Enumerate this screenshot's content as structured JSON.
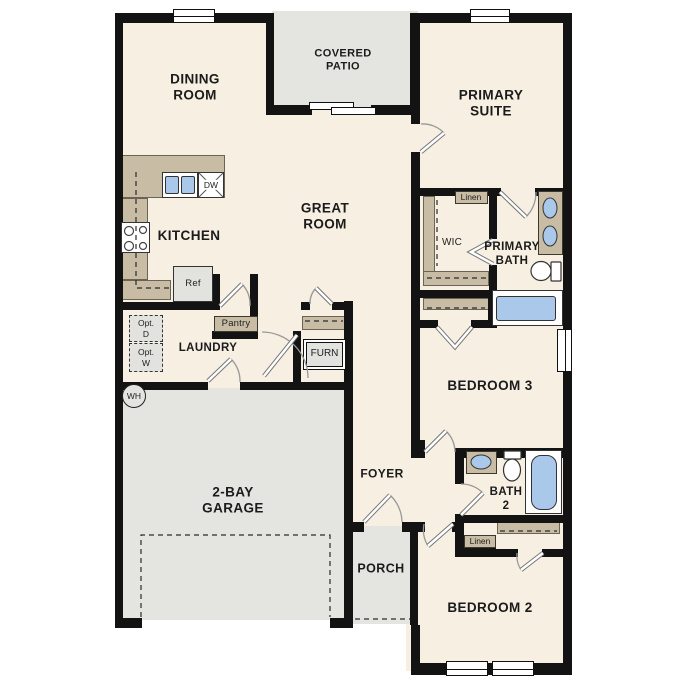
{
  "plan_title": "single-story floor plan",
  "colors": {
    "floor": "#f6efe2",
    "outdoor": "#e4e4e1",
    "wall": "#131313",
    "casework": "#c8bca4",
    "fixture_blue": "#a9c8ea",
    "appliance_gray": "#e2e2df",
    "text": "#1b1b1b"
  },
  "labels": {
    "dining": "DINING\nROOM",
    "covered_patio": "COVERED\nPATIO",
    "primary_suite": "PRIMARY\nSUITE",
    "great_room": "GREAT\nROOM",
    "kitchen": "KITCHEN",
    "laundry": "LAUNDRY",
    "wic": "WIC",
    "primary_bath": "PRIMARY\nBATH",
    "bedroom3": "BEDROOM 3",
    "foyer": "FOYER",
    "bath2": "BATH\n2",
    "garage": "2-BAY\nGARAGE",
    "porch": "PORCH",
    "bedroom2": "BEDROOM 2"
  },
  "fixtures": {
    "dishwasher": "DW",
    "refrigerator": "Ref",
    "pantry": "Pantry",
    "furnace": "FURN",
    "linen_primary": "Linen",
    "linen_hall": "Linen",
    "optional_dryer": "Opt.\nD",
    "optional_washer": "Opt.\nW",
    "water_heater": "WH"
  }
}
